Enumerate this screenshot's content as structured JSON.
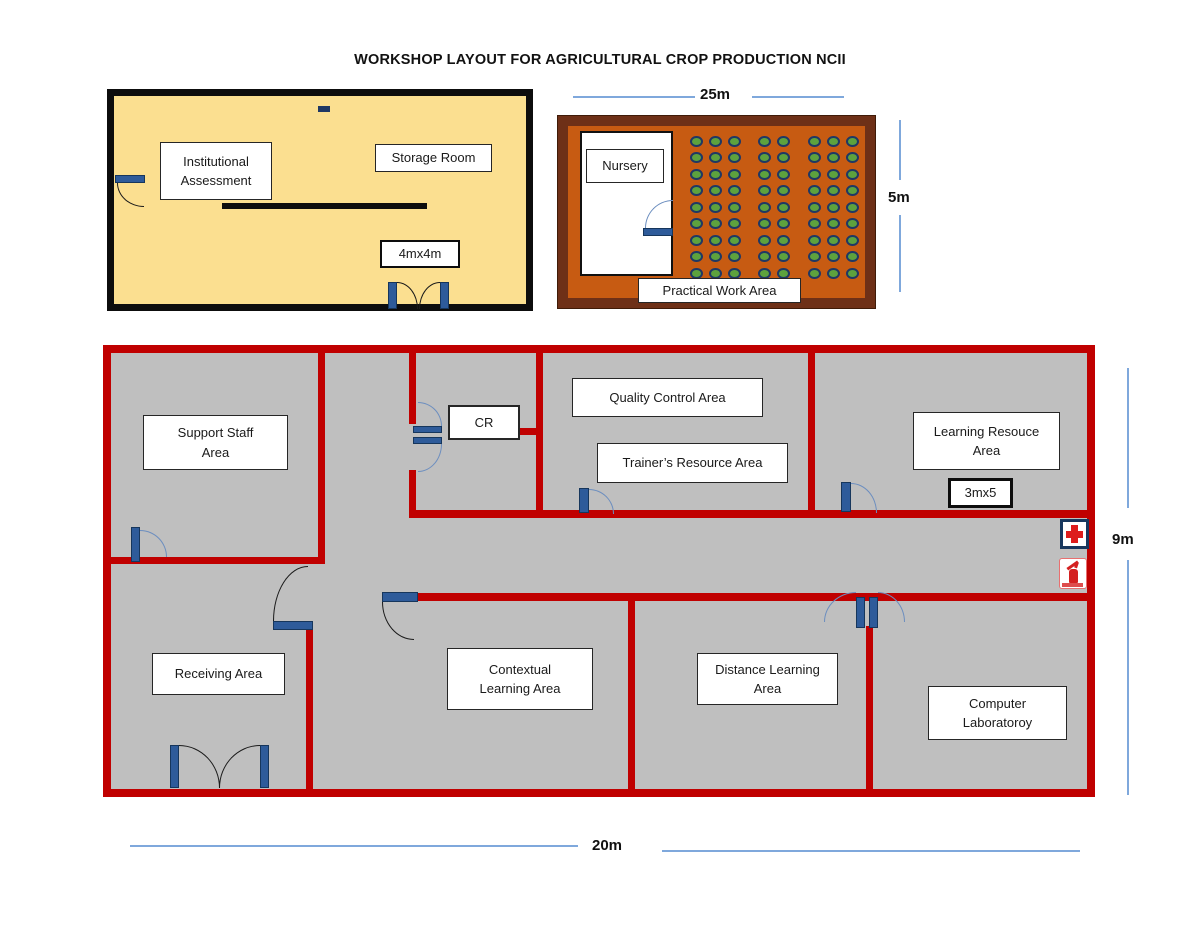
{
  "title": "WORKSHOP LAYOUT FOR AGRICULTURAL CROP PRODUCTION NCII",
  "assessment_room": {
    "labels": {
      "institutional_assessment": "Institutional\nAssessment",
      "storage_room": "Storage Room",
      "size": "4mx4m"
    }
  },
  "practical_area": {
    "labels": {
      "nursery": "Nursery",
      "practical_work_area": "Practical Work Area"
    },
    "dimensions": {
      "width": "25m",
      "height": "5m"
    },
    "plants": {
      "rows": 9,
      "row_start_y": 141,
      "row_step": 16.5,
      "column_x": [
        696,
        715,
        734,
        764,
        783,
        814,
        833,
        852
      ]
    }
  },
  "workshop": {
    "rooms": {
      "support_staff": "Support Staff\nArea",
      "cr": "CR",
      "quality_control": "Quality Control Area",
      "trainers_resource": "Trainer’s Resource Area",
      "learning_resource": "Learning Resouce\nArea",
      "learning_resource_size": "3mx5",
      "receiving": "Receiving Area",
      "contextual": "Contextual\nLearning Area",
      "distance": "Distance Learning\nArea",
      "computer": "Computer\nLaboratoroy"
    },
    "dimensions": {
      "width": "20m",
      "height": "9m"
    }
  },
  "colors": {
    "wall_red": "#C00000",
    "floor_gray": "#BFBFBF",
    "room_yellow": "#FBDF90",
    "room_border_black": "#0D0D0D",
    "brown_dark": "#6E3017",
    "brown_light": "#C75B12",
    "plant_green": "#5DA23D",
    "plant_ring_navy": "#1F3864",
    "door_navy": "#2E5B9A",
    "arc_blue": "#6C8EBF",
    "dimension_blue": "#7FA8DC",
    "cross_red": "#DD1C1C"
  }
}
